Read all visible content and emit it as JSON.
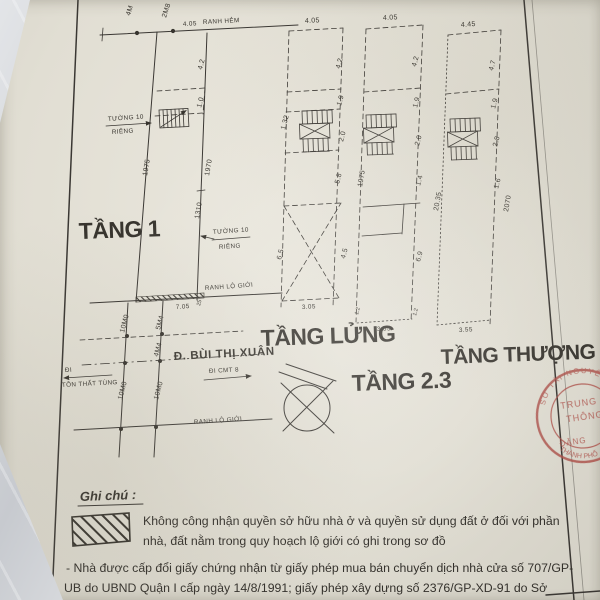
{
  "floor1": {
    "title": "TẦNG 1",
    "alley_dim_a": "4M",
    "alley_dim_b": "2M8",
    "alley_dim": "4.05",
    "alley_label": "RANH HẺM",
    "left_dim": "1975",
    "right_dim_upper": "1970",
    "right_dim_lower": "1310",
    "room_dim_a": "4.2",
    "room_dim_b": "1.0",
    "wall_note_top_line1": "TƯỜNG 10",
    "wall_note_top_line2": "RIÊNG",
    "wall_note_right_line1": "TƯỜNG 10",
    "wall_note_right_line2": "RIÊNG",
    "boundary_label": "RANH LỘ GIỚI",
    "hatch_dim": "7.05",
    "hatch_dim_small": "25"
  },
  "street": {
    "name": "Đ. BÙI THỊ XUÂN",
    "boundary_label": "RANH LỘ GIỚI",
    "dir_right": "ĐI CMT 8",
    "dir_left": "ĐI",
    "cross_street": "TÔN THẤT TÙNG",
    "dim_left_top": "10M0",
    "dim_left_bottom": "10M0",
    "dim_right_top": "5M4",
    "dim_right_mid": "4M4",
    "dim_right_bottom": "10M0"
  },
  "mezzanine": {
    "title": "TẦNG LỬNG",
    "top_dim": "4.05",
    "right_dims": [
      "4.2",
      "1.9",
      "2.0",
      "5.8"
    ],
    "left_dim_upper": "1.32",
    "void_left_dim": "6.5",
    "void_right_dim": "4.5",
    "bottom_dim": "3.05"
  },
  "floor23": {
    "title": "TẦNG 2.3",
    "top_dim": "4.05",
    "right_dims": [
      "4.2",
      "1.9",
      "2.0",
      "1.4"
    ],
    "left_total_dim": "1975",
    "room_right_dim": "6.9",
    "bottom_left_dim": "1.2",
    "bottom_right_dim": "1.2",
    "bottom_dim": "3.55"
  },
  "topfloor": {
    "title": "TẦNG THƯỢNG",
    "top_dim": "4.45",
    "right_dims": [
      "4.7",
      "1.9",
      "2.8",
      "1.6"
    ],
    "left_total_dim": "20.35",
    "right_total_dim": "2070",
    "bottom_dim": "3.55"
  },
  "legend": {
    "heading": "Ghi chú :",
    "line1": "Không công nhận quyền sở hữu nhà ở và quyền sử dụng đất ở đối với phần",
    "line2": "nhà, đất nằm trong quy hoạch lộ giới có ghi trong sơ đồ"
  },
  "notes": {
    "line1": "- Nhà được cấp đổi giấy chứng nhận từ giấy phép mua bán chuyển dịch nhà cửa số 707/GP-",
    "line2": "UB do UBND Quận I cấp ngày 14/8/1991; giấy phép xây dựng số 2376/GP-XD-91 do Sở"
  },
  "stamp": {
    "arc_top": "SỞ TÀI NGUYÊN",
    "line1": "TRUNG",
    "line2": "THÔNG",
    "line3": "ĐĂNG",
    "arc_bottom": "THÀNH PHỐ",
    "color": "#ab4f48"
  },
  "colors": {
    "ink": "#3a3733",
    "paper": "#e1ded3",
    "stamp": "#ab4f48"
  }
}
